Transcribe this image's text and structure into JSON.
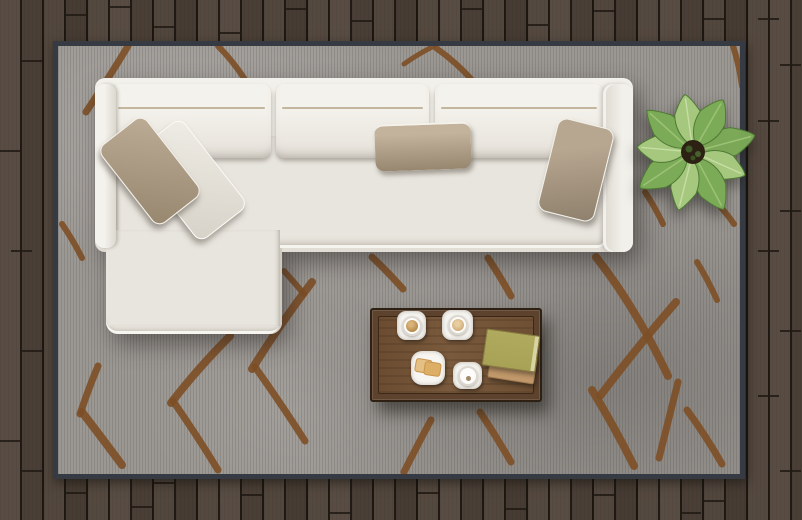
{
  "scene": {
    "description": "Top view of a modern living room: white L-shaped sectional sofa with taupe and white throw pillows on a gray rug with brown lattice pattern, walnut coffee table with two coffees, a plate of toast, an empty cup and two books, a green potted plant, all on a dark wood plank floor",
    "floor": {
      "description": "dark brown wood plank floor, planks laid vertically",
      "color": "#4f4339"
    },
    "rug": {
      "description": "large gray area rug with hand-drawn brown diamond lattice pattern and dark binding",
      "color": "#9b9793",
      "border_color": "#363b43",
      "pattern_color": "#7d4f26"
    },
    "sofa": {
      "description": "white L-shaped sectional sofa with left chaise, three back cushions and two armrests",
      "color": "#ebe8e1",
      "back_cushion_count": 3,
      "pillows": [
        {
          "name": "chaise taupe pillow",
          "color": "#bcab95"
        },
        {
          "name": "chaise white pillow",
          "color": "#efece5"
        },
        {
          "name": "center lumbar taupe pillow",
          "color": "#b2a28d"
        },
        {
          "name": "right taupe pillow",
          "color": "#b7a690"
        }
      ]
    },
    "coffee_table": {
      "description": "rectangular walnut coffee table with raised edge frame",
      "color": "#6f5034",
      "items": [
        {
          "name": "coffee cup with saucer",
          "contents_color": "#b78c4a"
        },
        {
          "name": "latte cup with saucer",
          "contents_color": "#cfa977"
        },
        {
          "name": "plate with two toast slices",
          "toast_color": "#e5c084"
        },
        {
          "name": "empty white cup with saucer"
        },
        {
          "name": "olive green book",
          "color": "#a8a256"
        },
        {
          "name": "tan book",
          "color": "#c0986a"
        }
      ]
    },
    "plant": {
      "description": "green broad-leaf potted plant seen from above, beside the sofa right arm",
      "leaf_color": "#7cab57"
    }
  },
  "palette": {
    "floor": "#4f4339",
    "floor-seam": "#211a14",
    "rug": "#9b9793",
    "rug-border": "#363b43",
    "rug-line": "#7d4f26",
    "sofa": "#ebe8e1",
    "sofa-shade": "#d9d5cb",
    "seat": "#e8e5de",
    "piping": "#b3a284",
    "pillow-taupe": "#bcab95",
    "pillow-taupe-dark": "#97876f",
    "pillow-white": "#efece5",
    "table-frame": "#5d432d",
    "table-top": "#6f5034",
    "table-edge": "#2f2014",
    "coffee": "#b78c4a",
    "latte": "#cfa977",
    "toast": "#e5c084",
    "toast-crust": "#c8954f",
    "book-green": "#a8a256",
    "book-tan": "#c0986a",
    "leaf-light": "#a5c87e",
    "leaf-mid": "#7cab57",
    "leaf-dark": "#4f7a35",
    "soil": "#2c2112"
  }
}
